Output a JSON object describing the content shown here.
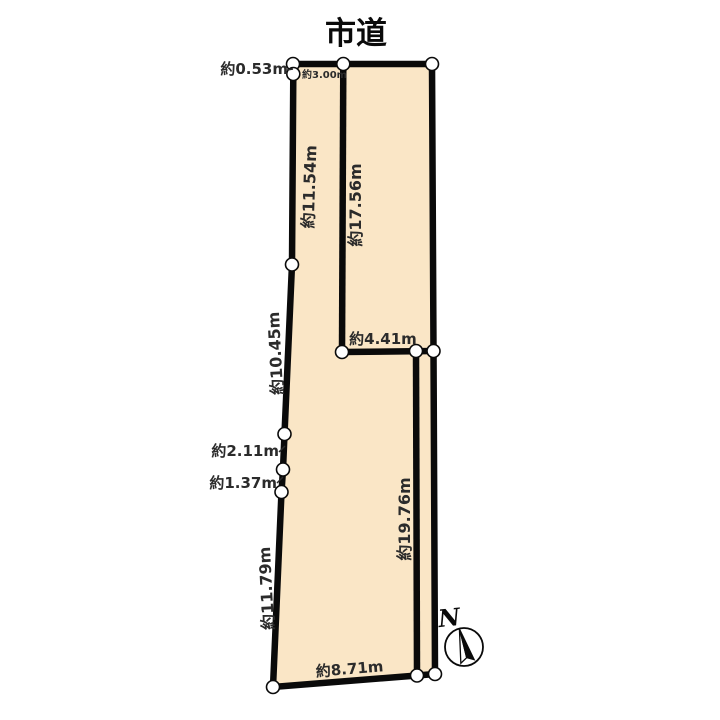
{
  "diagram": {
    "road_label": "市道",
    "measurements": {
      "m053": "約0.53m",
      "m300": "約3.00m",
      "m1154": "約11.54m",
      "m1756": "約17.56m",
      "m1045": "約10.45m",
      "m211": "約2.11m",
      "m137": "約1.37m",
      "m1179": "約11.79m",
      "m441": "約4.41m",
      "m1976": "約19.76m",
      "m871": "約8.71m"
    },
    "compass": {
      "north_label": "N"
    },
    "colors": {
      "parcel_fill": "#FAE6C6",
      "outline": "#0a0a0a",
      "label_text": "#2b2b2b"
    }
  }
}
